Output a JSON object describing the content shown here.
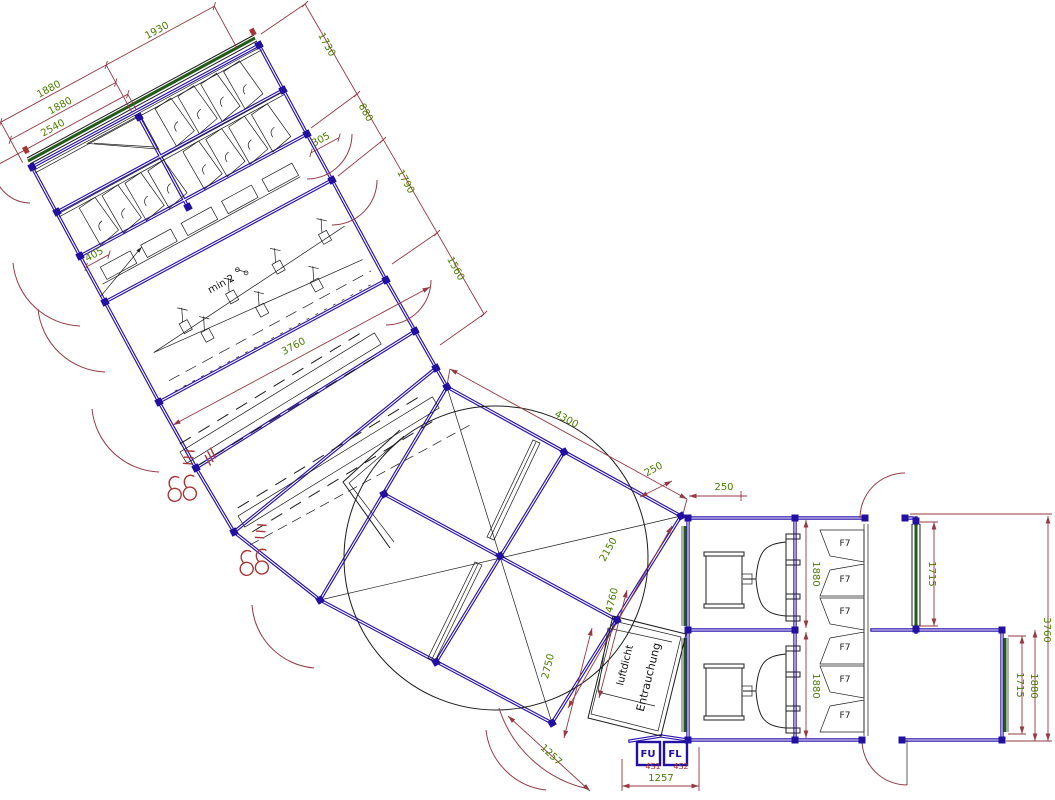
{
  "drawing": {
    "type": "CAD floor plan of modular container/tent installation with ventilation plant",
    "colors": {
      "wall_blue": "#2a12ae",
      "dimension_line_red": "#943a44",
      "dimension_text_green": "#4a7c00",
      "window_green": "#235c18",
      "symbol_red": "#a83535",
      "line_black": "#1c1c1c",
      "background": "#ffffff"
    },
    "dims": {
      "a_top_1880": "1880",
      "a_top_1930": "1930",
      "a_mid_1880": "1880",
      "a_2540": "2540",
      "a_405": "405",
      "a_305": "305",
      "chain_1730": "1730",
      "chain_880": "880",
      "chain_1790": "1790",
      "chain_1560": "1560",
      "hall_3760": "3760",
      "d_4300": "4300",
      "d_250_rot": "250",
      "d_250_h": "250",
      "d_2150": "2150",
      "d_2750": "2750",
      "d_4760": "4760",
      "d_1257_rot": "1257",
      "d_1257_h": "1257",
      "r_1880_top": "1880",
      "r_1880_bot": "1880",
      "r_1715_top": "1715",
      "r_1715_bot": "1715",
      "r_1880_right": "1880",
      "r_3760": "3760"
    },
    "labels": {
      "min_slope": "min 2",
      "luftdicht": "luftdicht",
      "entrauchung": "Entrauchung",
      "f7": "F7",
      "box_fu": "FU",
      "box_fl": "FL",
      "sub_fu": "4S1",
      "sub_fl": "4S2"
    }
  }
}
